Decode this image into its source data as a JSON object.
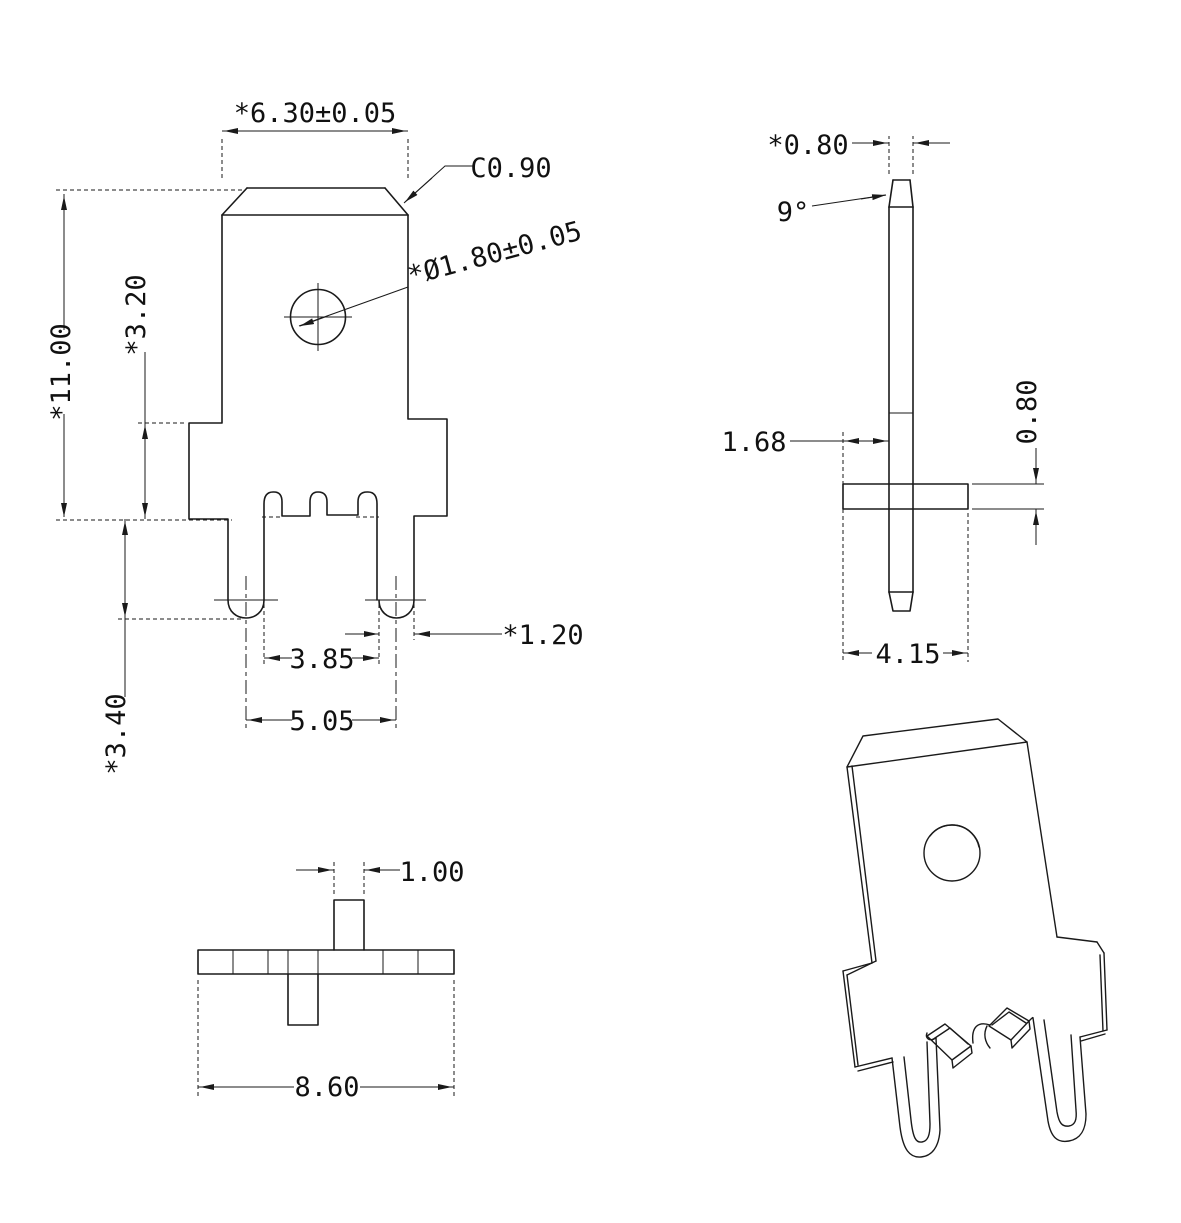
{
  "drawing": {
    "type": "technical-drawing",
    "part": "PCB solder tab terminal",
    "views": {
      "front": {
        "dims": {
          "blade_width": "*6.30±0.05",
          "chamfer": "C0.90",
          "hole_dia": "*Ø1.80±0.05",
          "overall_height": "*11.00",
          "shoulder_height": "*3.20",
          "leg_length": "*3.40",
          "leg_inner_gap": "3.85",
          "leg_pitch": "5.05",
          "leg_width": "*1.20"
        }
      },
      "side": {
        "dims": {
          "blade_thickness": "*0.80",
          "tip_angle": "9°",
          "blade_offset": "1.68",
          "flange_thickness": "0.80",
          "flange_width": "4.15"
        }
      },
      "bottom": {
        "dims": {
          "tab_width": "1.00",
          "overall_width": "8.60"
        }
      }
    },
    "line_color": "#1a1a1a",
    "background": "#ffffff"
  }
}
